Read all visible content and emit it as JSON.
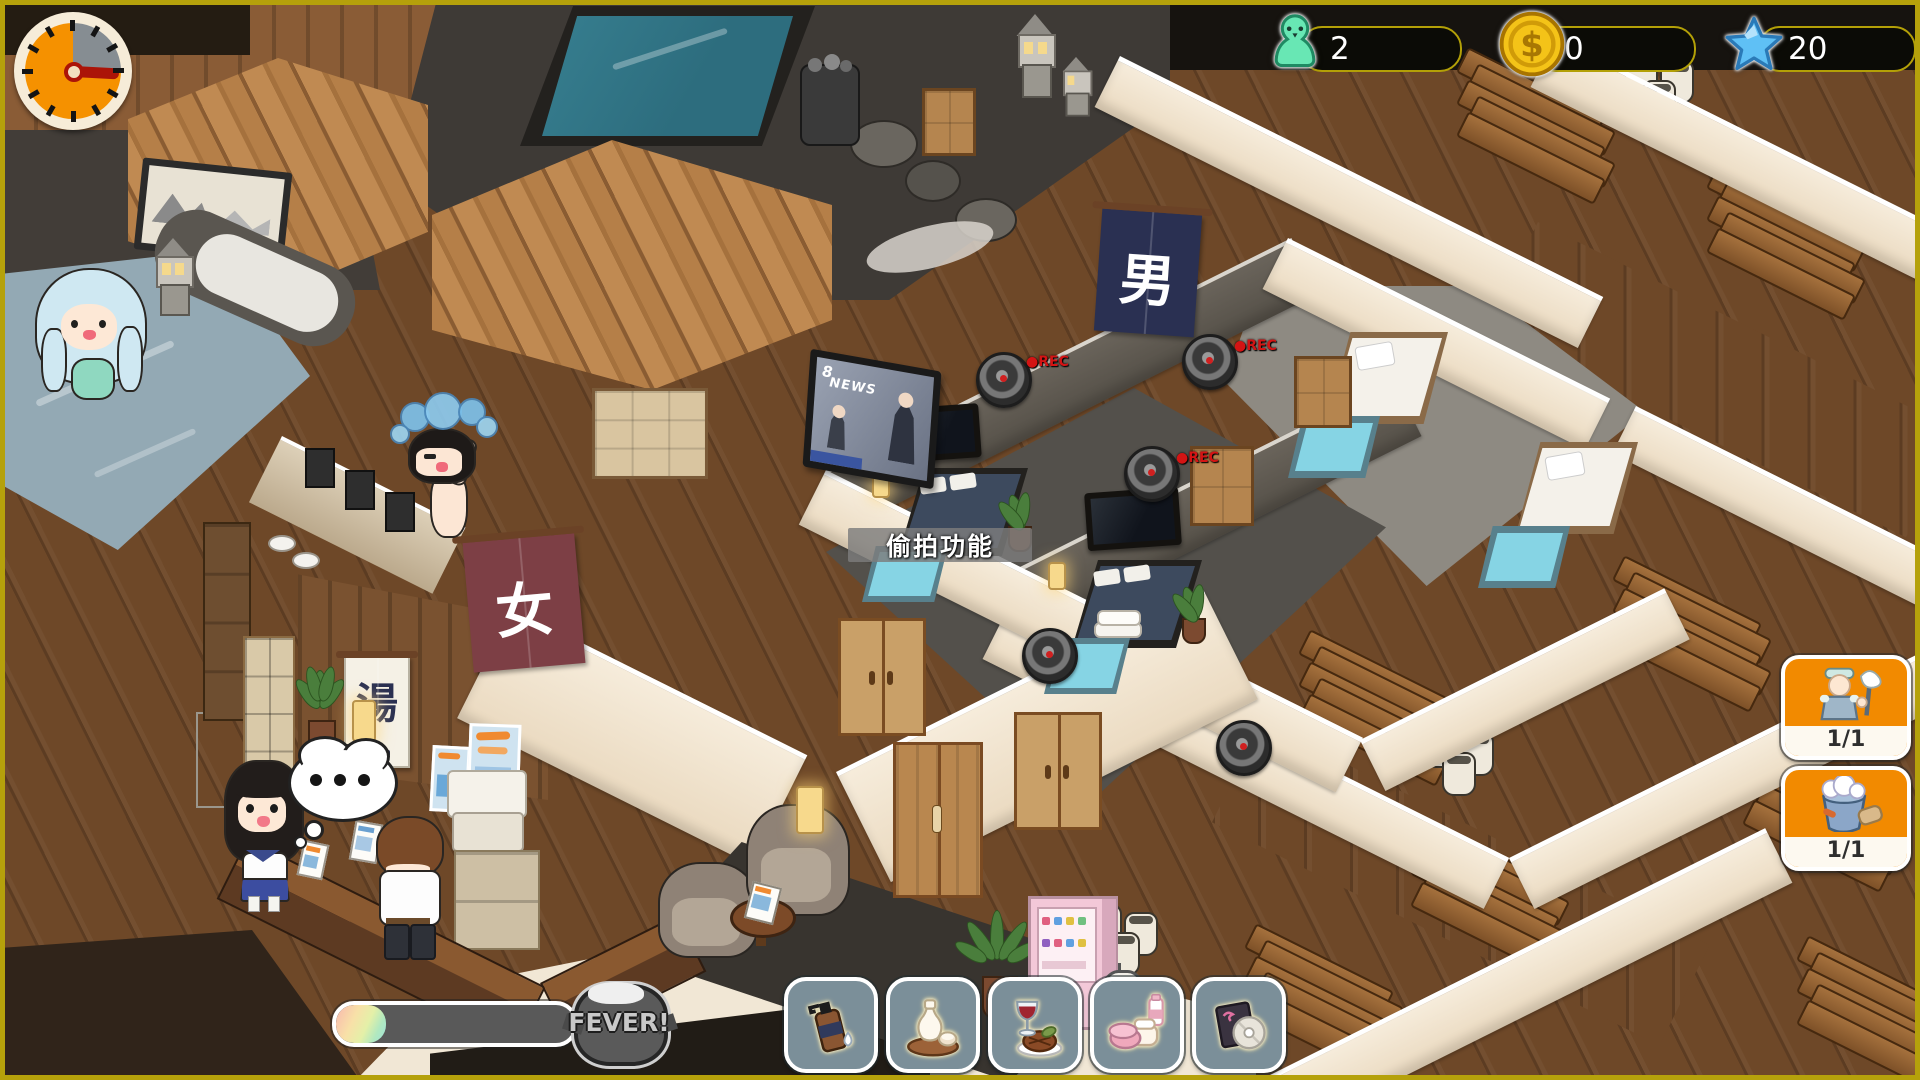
{
  "hud": {
    "clock": {
      "icon": "day-timer-clock-icon",
      "elapsed_fraction": 0.75
    },
    "counters": {
      "guests": {
        "icon": "guest-pawn-icon",
        "value": "2",
        "icon_color": "#68e7b4"
      },
      "coins": {
        "icon": "coin-icon",
        "value": "0",
        "icon_color": "#f4c318"
      },
      "stars": {
        "icon": "star-icon",
        "value": "20",
        "icon_color": "#5fc0f5"
      }
    },
    "tooltip": {
      "text": "偷拍功能"
    },
    "staff_panel": [
      {
        "icon": "cleaning-staff-icon",
        "count": "1/1"
      },
      {
        "icon": "bath-bucket-icon",
        "count": "1/1"
      }
    ],
    "fever": {
      "label": "FEVER!",
      "progress_percent": 21,
      "icon": "fever-tub-icon"
    },
    "item_bar": [
      {
        "icon": "shampoo-bottle-icon",
        "name": "shampoo"
      },
      {
        "icon": "sake-set-icon",
        "name": "sake"
      },
      {
        "icon": "meal-wine-icon",
        "name": "meal"
      },
      {
        "icon": "cosmetics-icon",
        "name": "cosmetics"
      },
      {
        "icon": "cd-disc-icon",
        "name": "cd"
      }
    ]
  },
  "scene": {
    "signs": {
      "men_noren": "男",
      "women_noren": "女",
      "yu_banner": "湯"
    },
    "tv": {
      "channel": "8",
      "news_label": "NEWS"
    },
    "camera_rec_label": "●REC",
    "thought_bubble": {
      "type": "thinking",
      "dots": 3
    },
    "colors": {
      "frame_border": "#b5a10b",
      "hud_pill_border": "#b3a007",
      "staff_button_orange": "#f28a00",
      "item_button_slate": "#7b8f99",
      "rec_red": "#d41414",
      "noren_navy": "#2a3052",
      "noren_maroon": "#7d3f45",
      "pool_teal": "#2d6d7e",
      "bath_gray_blue": "#93a9b4",
      "room_bath_blue": "#86d4e4",
      "fever_bar_gray": "#595959"
    }
  }
}
